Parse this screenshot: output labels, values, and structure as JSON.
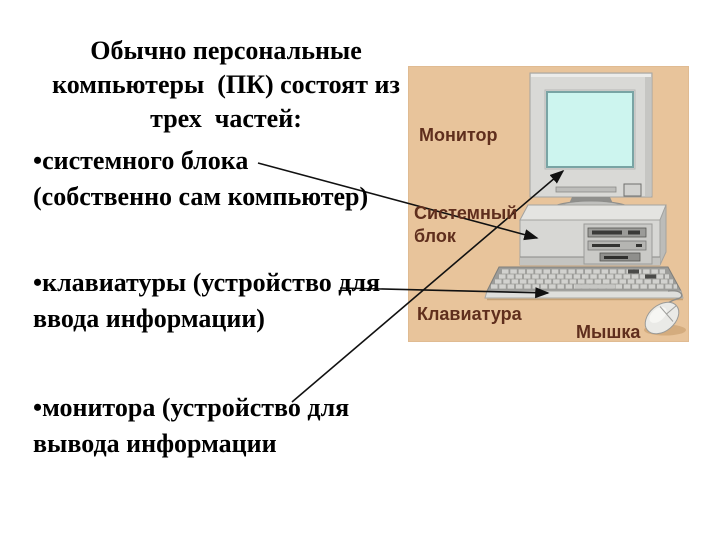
{
  "slide": {
    "heading": "Обычно персональные\nкомпьютеры  (ПК) состоят из\nтрех  частей:",
    "bullets": [
      {
        "text": "•системного блока\n(собственно сам компьютер)"
      },
      {
        "text": "•клавиатуры (устройство для\nввода информации)"
      },
      {
        "text": "•монитора (устройство для\nвывода информации"
      }
    ]
  },
  "figure": {
    "labels": {
      "monitor": "Монитор",
      "system_unit": "Системный\nблок",
      "keyboard": "Клавиатура",
      "mouse": "Мышка"
    },
    "colors": {
      "panel_bg": "#e8c49b",
      "label_text": "#5f2e1d",
      "screen": "#cdf5ef",
      "arrow": "#111111"
    }
  }
}
